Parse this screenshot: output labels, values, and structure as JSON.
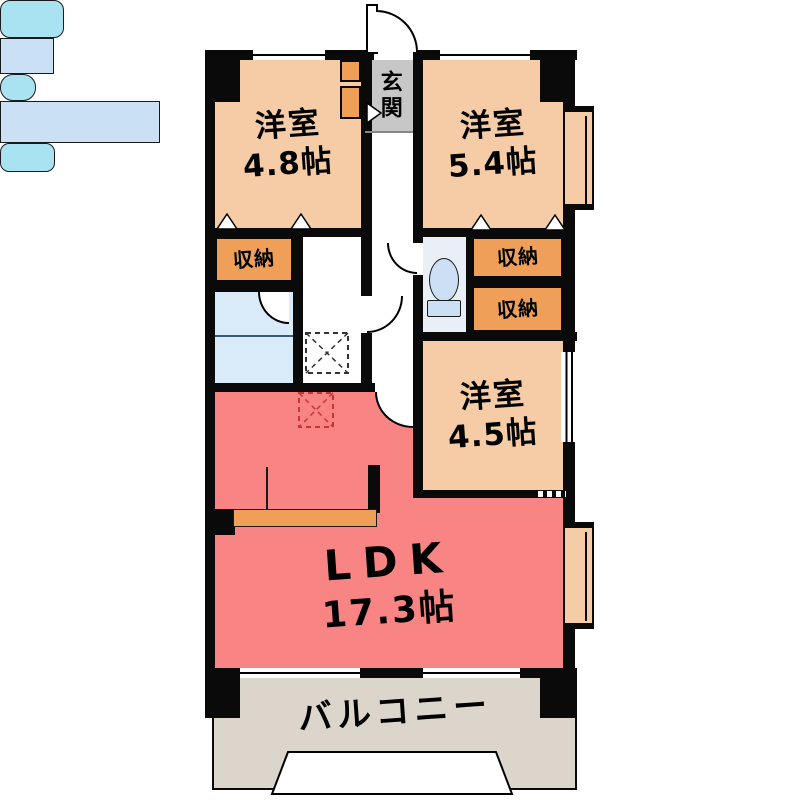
{
  "rooms": {
    "bedroom1": {
      "name": "洋室",
      "size": "4.8帖"
    },
    "bedroom2": {
      "name": "洋室",
      "size": "5.4帖"
    },
    "bedroom3": {
      "name": "洋室",
      "size": "4.5帖"
    },
    "ldk": {
      "name": "LDK",
      "size": "17.3帖"
    },
    "entrance": {
      "name": "玄関"
    },
    "balcony": {
      "name": "バルコニー"
    }
  },
  "storage": {
    "label": "収納"
  },
  "colors": {
    "room_fill": "#F5CCA6",
    "storage_fill": "#EF9F58",
    "ldk_fill": "#F88484",
    "entrance_fill": "#C7C7C7",
    "balcony_fill": "#DCD5CB",
    "water_fill": "#C9E0F5",
    "fixture_fill": "#A9E3F2",
    "wall": "#0A0A0A",
    "ps_marker": "#CC3333"
  }
}
